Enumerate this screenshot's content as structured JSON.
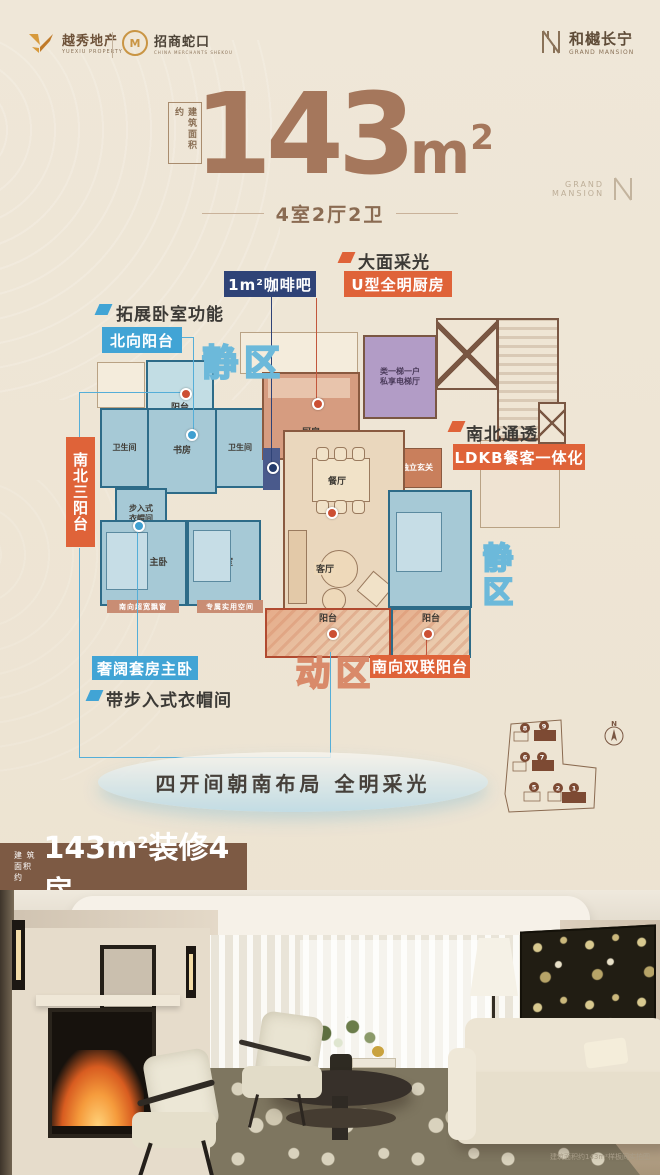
{
  "header": {
    "yuexiu": {
      "name": "越秀地产",
      "sub": "YUEXIU PROPERTY"
    },
    "shekou": {
      "name": "招商蛇口",
      "sub": "CHINA MERCHANTS SHEKOU"
    },
    "grand": {
      "name": "和樾长宁",
      "sub": "GRAND MANSION"
    }
  },
  "title": {
    "area_box": "建筑面积约",
    "value": "143",
    "unit": "m",
    "sup": "2",
    "layout": "4室2厅2卫",
    "watermark": {
      "l1": "GRAND",
      "l2": "MANSION"
    }
  },
  "colors": {
    "accent_orange": "#df6339",
    "accent_blue": "#41a4d5",
    "accent_navy": "#2f4377",
    "brand_brown": "#a5775c"
  },
  "floorplan": {
    "zones": {
      "quiet_top": "静区",
      "quiet_right": "静区",
      "active": "动区"
    },
    "callouts": {
      "expand_bedroom": "拓展卧室功能",
      "north_balcony": "北向阳台",
      "coffee_bar": "1m²咖啡吧",
      "daylight": "大面采光",
      "u_kitchen": "U型全明厨房",
      "three_balconies": "南北三阳台",
      "ns_through": "南北通透",
      "ldkb": "LDKB餐客一体化",
      "master_suite": "奢阔套房主卧",
      "walkin_closet": "带步入式衣帽间",
      "south_double_balcony": "南向双联阳台"
    },
    "rooms": {
      "balcony_n": "阳台",
      "bath_l": "卫生间",
      "study": "书房",
      "bath_r": "卫生间",
      "closet_l1": "步入式",
      "closet_l2": "衣帽间",
      "master": "主卧",
      "bedroom_m": "卧室",
      "kitchen": "厨房",
      "dining": "餐厅",
      "living": "客厅",
      "balcony_s1": "阳台",
      "balcony_s2": "阳台",
      "bedroom_r": "卧室",
      "foyer": "独立玄关",
      "elevator_l1": "类一梯一户",
      "elevator_l2": "私享电梯厅"
    },
    "strips": {
      "bay_window": "南向超宽飘窗",
      "utility_space": "专属实用空间"
    }
  },
  "slogan": "四开间朝南布局 全明采光",
  "siteplan": {
    "compass": "N",
    "buildings": [
      "8",
      "9",
      "6",
      "7",
      "5",
      "2",
      "1"
    ]
  },
  "banner": {
    "prefix_l1": "建 筑",
    "prefix_l2": "面积约",
    "value": "143m",
    "sup": "2",
    "suffix": "装修4房"
  },
  "photo": {
    "caption": "建筑面积约143m²样板间实拍图"
  }
}
